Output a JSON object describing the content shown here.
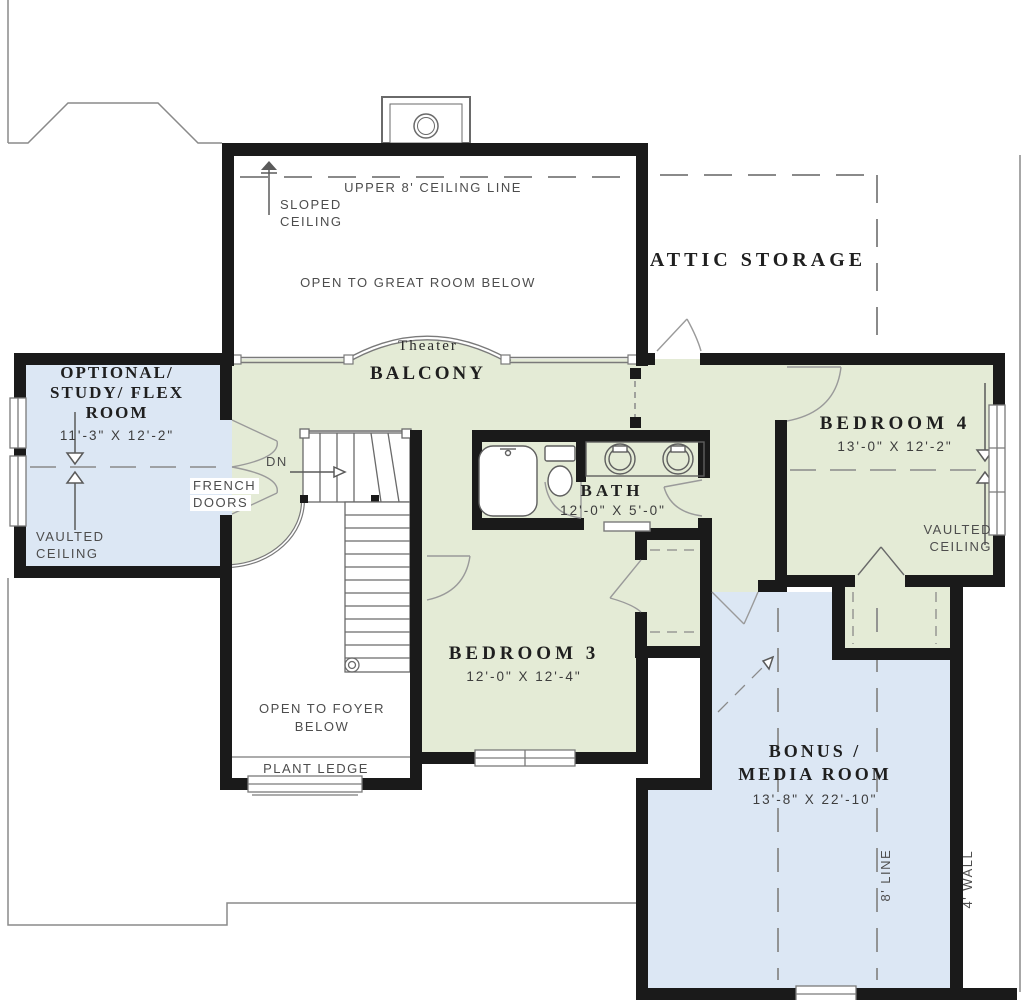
{
  "plan": {
    "great_room": {
      "ceiling_line": "UPPER 8' CEILING LINE",
      "sloped_1": "SLOPED",
      "sloped_2": "CEILING",
      "open_below": "OPEN TO GREAT ROOM BELOW"
    },
    "attic": {
      "name": "ATTIC STORAGE"
    },
    "balcony": {
      "theater": "Theater",
      "name": "BALCONY"
    },
    "study": {
      "name_1": "OPTIONAL/",
      "name_2": "STUDY/ FLEX",
      "name_3": "ROOM",
      "dims": "11'-3\" X 12'-2\"",
      "ceiling_1": "VAULTED",
      "ceiling_2": "CEILING",
      "doors_1": "FRENCH",
      "doors_2": "DOORS"
    },
    "stairs": {
      "down": "DN"
    },
    "bath": {
      "name": "BATH",
      "dims": "12'-0\" X 5'-0\""
    },
    "bedroom4": {
      "name": "BEDROOM 4",
      "dims": "13'-0\" X 12'-2\"",
      "ceiling_1": "VAULTED",
      "ceiling_2": "CEILING"
    },
    "bedroom3": {
      "name": "BEDROOM 3",
      "dims": "12'-0\" X 12'-4\""
    },
    "foyer": {
      "open_1": "OPEN TO FOYER",
      "open_2": "BELOW",
      "plant_ledge": "PLANT LEDGE"
    },
    "bonus": {
      "name_1": "BONUS /",
      "name_2": "MEDIA ROOM",
      "dims": "13'-8\" X 22'-10\"",
      "line_8": "8' LINE",
      "wall_4": "4' WALL"
    }
  },
  "colors": {
    "room_green": "#e4ebd6",
    "room_blue": "#dce7f4",
    "wall": "#1a1a1a",
    "thin_line": "#8a8a8a",
    "label_text": "#4d4d4d",
    "title_text": "#1f1f1f"
  }
}
